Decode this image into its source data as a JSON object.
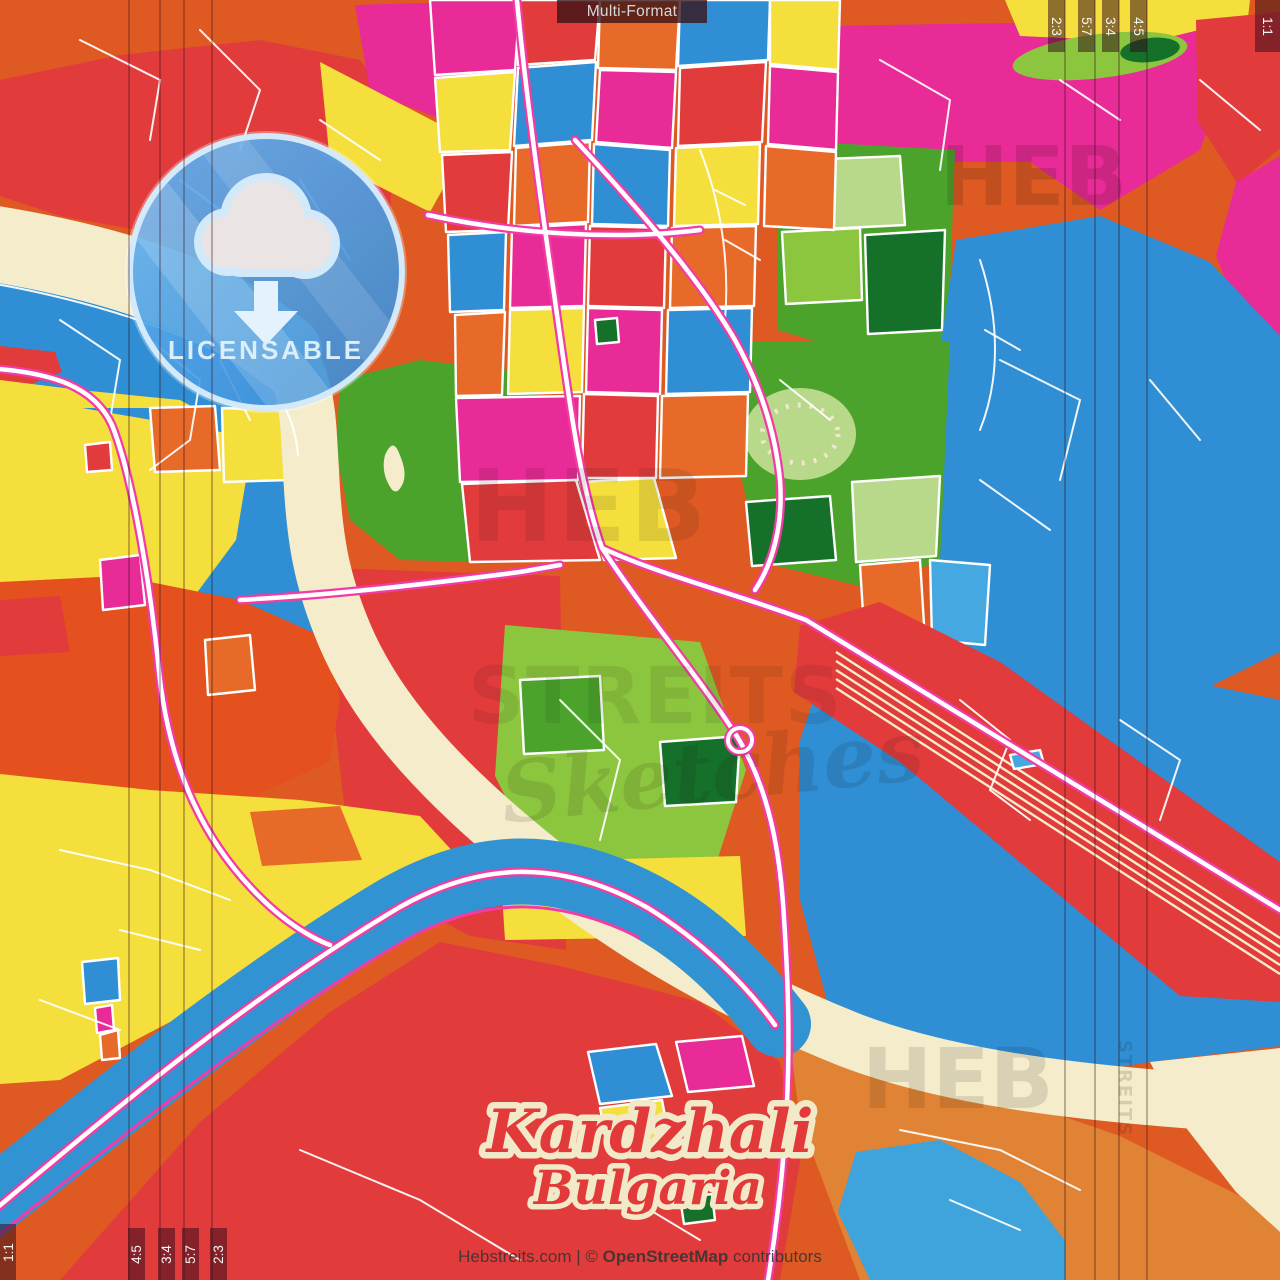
{
  "header": {
    "format_label": "Multi-Format"
  },
  "badge": {
    "label": "LICENSABLE",
    "icon": "cloud-download-icon"
  },
  "map_title": {
    "city": "Kardzhali",
    "country": "Bulgaria"
  },
  "attribution": {
    "prefix": "Hebstreits.com | © ",
    "brand": "OpenStreetMap",
    "suffix": " contributors"
  },
  "ratio_labels": {
    "top_right": [
      "2:3",
      "5:7",
      "3:4",
      "4:5"
    ],
    "top_right_corner": "1:1",
    "bottom_left": [
      "4:5",
      "3:4",
      "5:7",
      "2:3"
    ],
    "bottom_left_corner": "1:1"
  },
  "watermark": {
    "word1": "HEB",
    "word2": "STREITS",
    "word3": "Sketches"
  },
  "palette": {
    "base_orange": "#de5a22",
    "red": "#e23b3b",
    "magenta": "#e82b96",
    "blue": "#2f8ed4",
    "yellow": "#f5df3d",
    "green": "#4ba32c",
    "paper_cream": "#f4ecca",
    "water_blue": "#3293d3",
    "road_accent": "#f23ba5",
    "title_red": "#e23a3a",
    "badge_blue": "#58a8e8"
  }
}
